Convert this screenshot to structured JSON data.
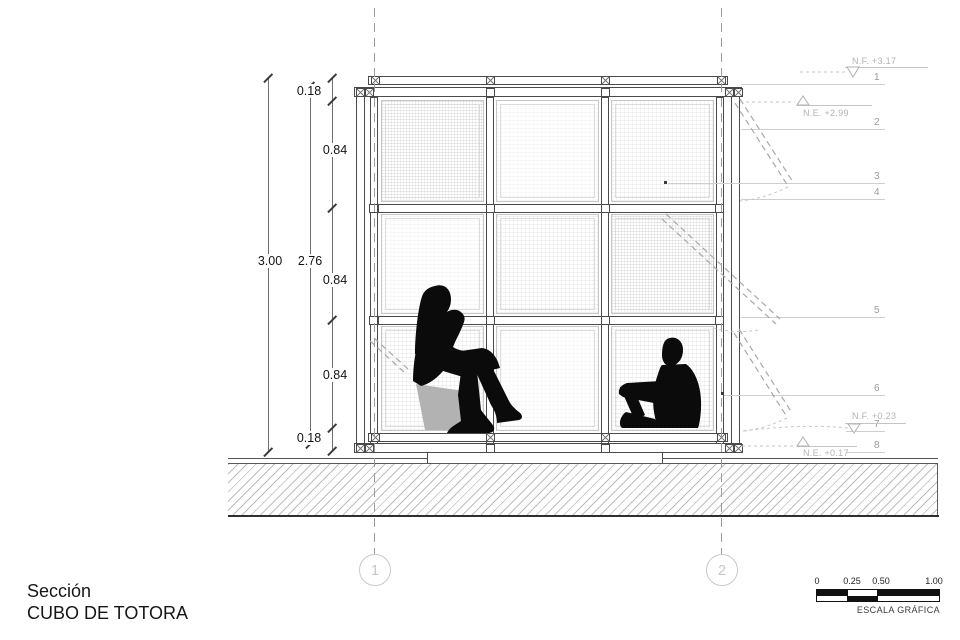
{
  "title": {
    "line1": "Sección",
    "line2": "CUBO DE TOTORA"
  },
  "dimensions": {
    "overall": "3.00",
    "inner": "2.76",
    "segments": [
      "0.18",
      "0.84",
      "0.84",
      "0.84",
      "0.18"
    ]
  },
  "levels": [
    {
      "label": "N.F. +3.17"
    },
    {
      "label": "N.E. +2.99"
    },
    {
      "label": "N.F. +0.23"
    },
    {
      "label": "N.E. +0.17"
    }
  ],
  "callouts": [
    "1",
    "2",
    "3",
    "4",
    "5",
    "6",
    "7",
    "8"
  ],
  "grid_bubbles": [
    "1",
    "2"
  ],
  "scale_bar": {
    "ticks": [
      "0",
      "0.25",
      "0.50",
      "1.00"
    ],
    "caption": "ESCALA GRÁFICA"
  },
  "colors": {
    "silhouette": "#0b0b0b",
    "seat_block_gray": "#b2b2b2",
    "structure_line": "#4a4a4a",
    "annotation_gray": "#9a9a9a",
    "level_gray": "#b3b3b3",
    "background": "#ffffff"
  }
}
